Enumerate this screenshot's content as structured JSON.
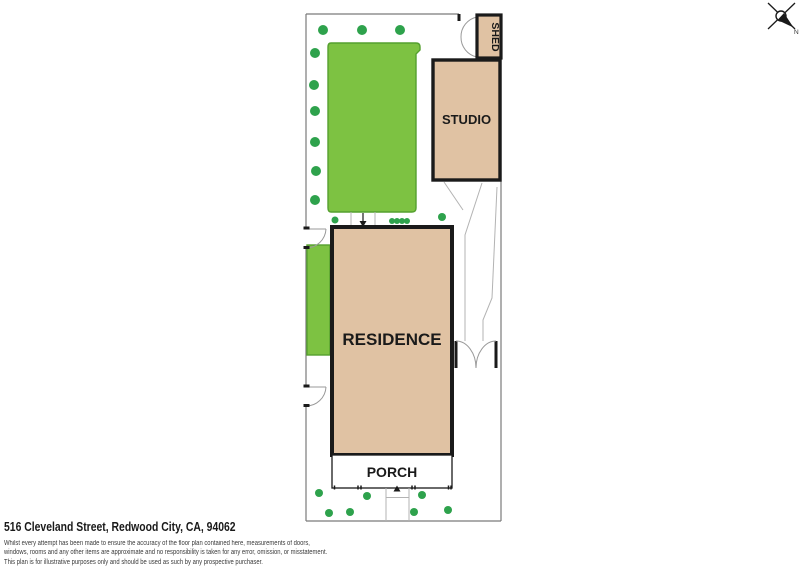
{
  "plan": {
    "buildings": {
      "residence": "RESIDENCE",
      "studio": "STUDIO",
      "shed": "SHED",
      "porch": "PORCH"
    },
    "compass": {
      "north_label": "N"
    }
  },
  "footer": {
    "address": "516 Cleveland Street, Redwood City, CA, 94062",
    "disclaimer_lines": [
      "Whilst every attempt has been made to ensure the accuracy of the floor plan contained here, measurements of doors,",
      "windows, rooms and any other items are approximate and no responsibility is taken for any error, omission, or misstatement.",
      "This plan is for illustrative purposes only and should be used as such by any prospective purchaser."
    ]
  },
  "colors": {
    "lawn": "#7dc242",
    "lawn_border": "#55a02f",
    "shrub": "#2ea24c",
    "building_fill": "#e0c2a3",
    "wall": "#1a1a1a",
    "boundary": "#7a7a7a",
    "path": "#b3b3b3",
    "text": "#1a1a1a"
  }
}
